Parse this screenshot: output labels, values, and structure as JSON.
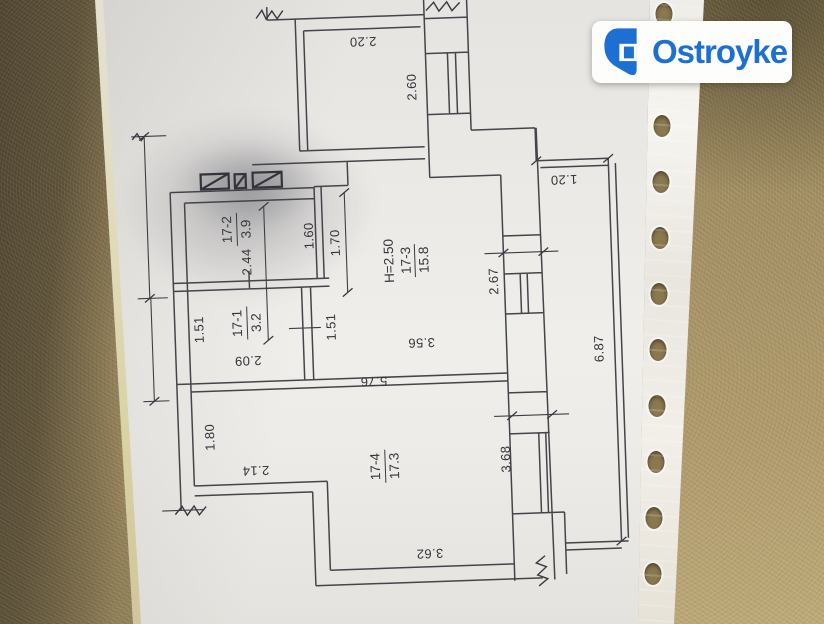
{
  "watermark": {
    "brand": "Ostroyke",
    "accent_color": "#1e6fd2",
    "badge_background": "#ffffff"
  },
  "colors": {
    "carpet": "#a6925f",
    "carpet_shadow": "#4f4430",
    "paper": "#e9e7e4",
    "ink": "#45444a",
    "punch_hole": "#8a784f"
  },
  "floor_plan": {
    "rooms": [
      {
        "id": "17-2",
        "area": "3.9"
      },
      {
        "id": "17-1",
        "area": "3.2"
      },
      {
        "id": "17-3",
        "area": "15.8",
        "ceiling_height": "H=2.50"
      },
      {
        "id": "17-4",
        "area": "17.3"
      }
    ],
    "dimensions": [
      {
        "value": "2.20"
      },
      {
        "value": "2.60"
      },
      {
        "value": "1.20"
      },
      {
        "value": "6.87"
      },
      {
        "value": "2.67"
      },
      {
        "value": "3.68"
      },
      {
        "value": "1.60"
      },
      {
        "value": "1.70"
      },
      {
        "value": "2.44"
      },
      {
        "value": "1.51"
      },
      {
        "value": "1.51"
      },
      {
        "value": "2.09"
      },
      {
        "value": "3.56"
      },
      {
        "value": "5.76"
      },
      {
        "value": "1.80"
      },
      {
        "value": "2.14"
      },
      {
        "value": "3.62"
      }
    ]
  }
}
